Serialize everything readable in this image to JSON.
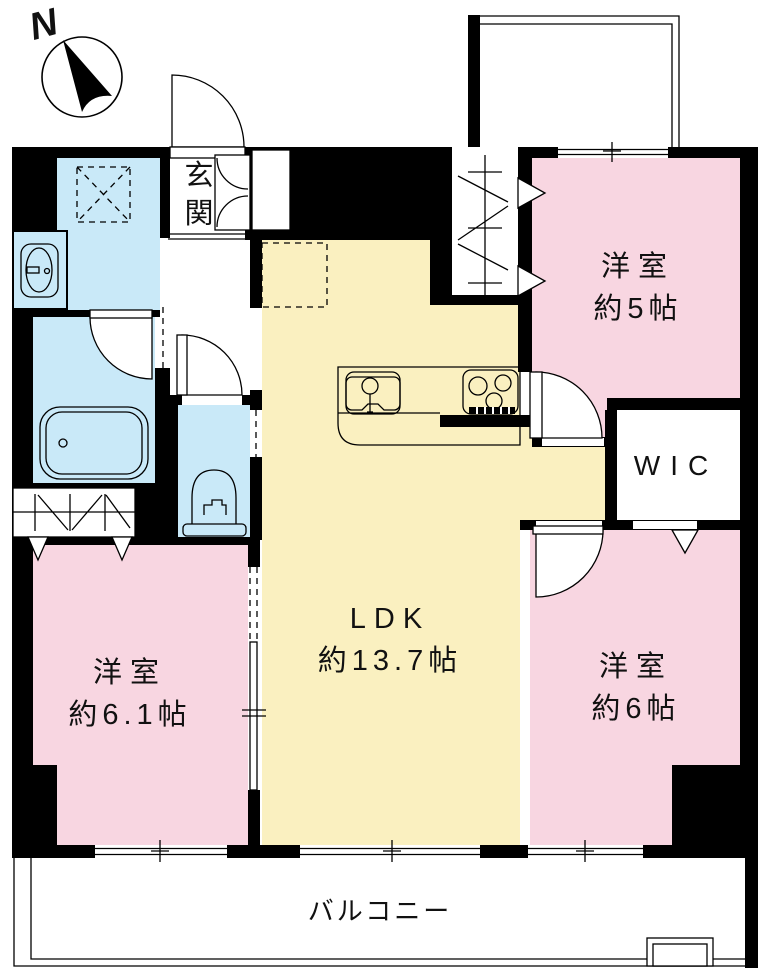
{
  "compass": {
    "label": "N"
  },
  "rooms": {
    "genkan": {
      "label": "玄関"
    },
    "ldk": {
      "label": "LDK",
      "size": "約13.7帖"
    },
    "bedroom5": {
      "label": "洋室",
      "size": "約5帖"
    },
    "bedroom6": {
      "label": "洋室",
      "size": "約6帖"
    },
    "bedroom61": {
      "label": "洋室",
      "size": "約6.1帖"
    },
    "wic": {
      "label": "WIC"
    },
    "balcony": {
      "label": "バルコニー"
    }
  },
  "colors": {
    "wall": "#000000",
    "bedroom": "#F8D6E1",
    "ldk": "#FAF0C0",
    "wet": "#C9E9F8",
    "background": "#FFFFFF"
  }
}
